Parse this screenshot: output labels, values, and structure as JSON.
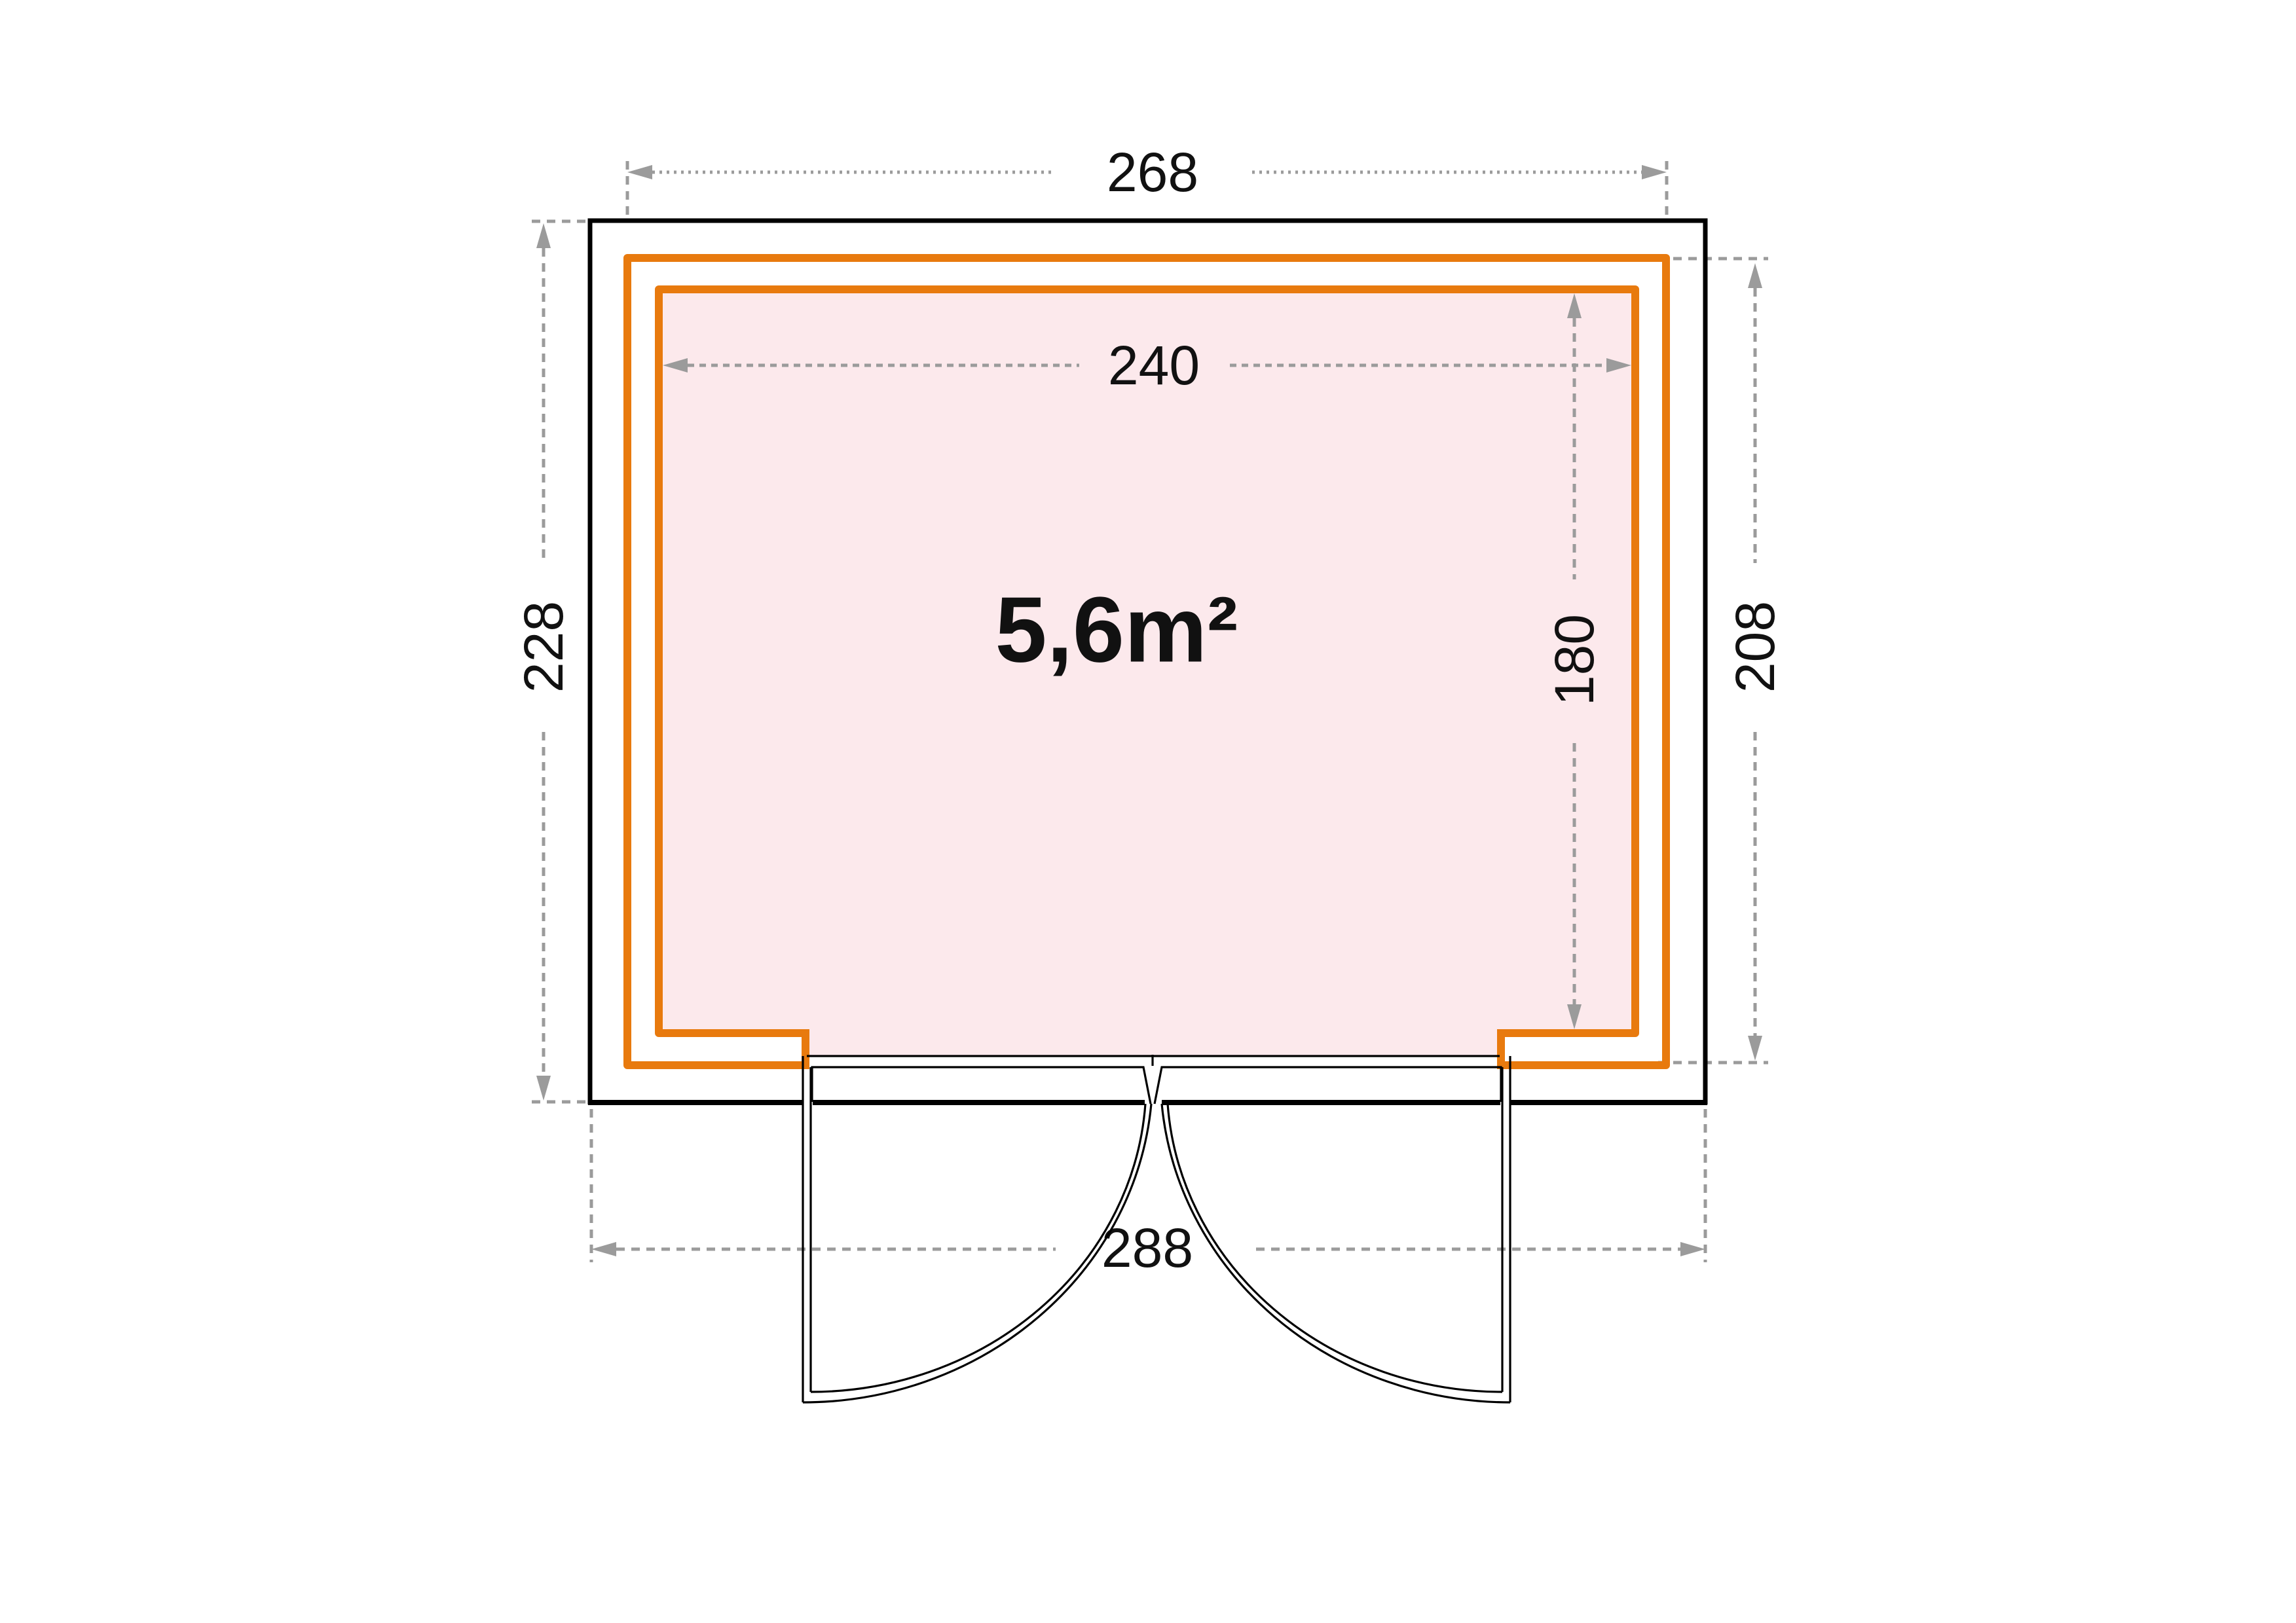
{
  "colors": {
    "wall_orange": "#E87A0E",
    "interior_pink": "#FCE9EC",
    "dim_gray": "#9B9B9B",
    "wall_black": "#000000",
    "text_ink": "#111111"
  },
  "plan": {
    "area_label": "5,6m²",
    "dimensions": {
      "outer_width_top": "268",
      "inner_width": "240",
      "left_height": "228",
      "right_height": "208",
      "inner_height": "180",
      "overall_width_bottom": "288"
    }
  }
}
